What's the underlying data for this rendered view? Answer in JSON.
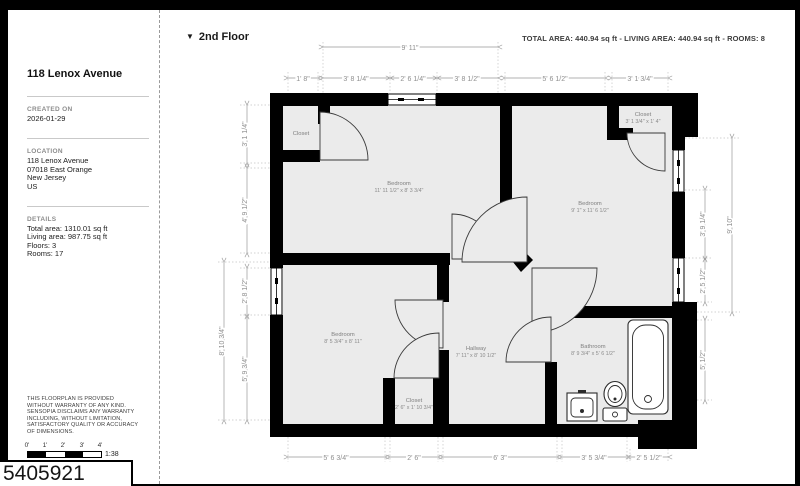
{
  "page": {
    "id_label": "5405921"
  },
  "header": {
    "floor_selector": "2nd Floor",
    "dropdown_icon": "▼",
    "summary": "TOTAL AREA: 440.94 sq ft - LIVING AREA: 440.94 sq ft - ROOMS: 8"
  },
  "sidebar": {
    "title": "118 Lenox Avenue",
    "created": {
      "heading": "CREATED ON",
      "value": "2026-01-29"
    },
    "location": {
      "heading": "LOCATION",
      "lines": [
        "118 Lenox Avenue",
        "07018 East Orange",
        "New Jersey",
        "US"
      ]
    },
    "details": {
      "heading": "DETAILS",
      "lines": [
        "Total area: 1310.01 sq ft",
        "Living area: 987.75 sq ft",
        "Floors: 3",
        "Rooms: 17"
      ]
    },
    "disclaimer": "THIS FLOORPLAN IS PROVIDED WITHOUT WARRANTY OF ANY KIND. SENSOPIA DISCLAIMS ANY WARRANTY INCLUDING, WITHOUT LIMITATION, SATISFACTORY QUALITY OR ACCURACY OF DIMENSIONS.",
    "scale": {
      "ticks": [
        "0'",
        "1'",
        "2'",
        "3'",
        "4'"
      ],
      "ratio": "1:38"
    }
  },
  "plan": {
    "rooms": [
      {
        "name": "Closet",
        "size": ""
      },
      {
        "name": "Bedroom",
        "size": "11' 11 1/2\" x 8' 3 3/4\""
      },
      {
        "name": "Closet",
        "size": "3' 1 3/4\" x 1' 4\""
      },
      {
        "name": "Bedroom",
        "size": "9' 1\" x 11' 6 1/2\""
      },
      {
        "name": "Bedroom",
        "size": "8' 5 3/4\" x 8' 11\""
      },
      {
        "name": "Closet",
        "size": "2' 6\" x 1' 10 3/4\""
      },
      {
        "name": "Hallway",
        "size": "7' 11\" x 8' 10 1/2\""
      },
      {
        "name": "Bathroom",
        "size": "8' 9 3/4\" x 5' 6 1/2\""
      }
    ],
    "dims": {
      "top_outer": "9' 11\"",
      "top": [
        "1' 8\"",
        "3' 8 1/4\"",
        "2' 6 1/4\"",
        "3' 8 1/2\"",
        "5' 6 1/2\"",
        "3' 1 3/4\""
      ],
      "bottom": [
        "5' 6 3/4\"",
        "2' 6\"",
        "6' 3\"",
        "3' 5 3/4\"",
        "2' 5 1/2\""
      ],
      "left": [
        "3' 1 1/4\"",
        "4' 9 1/2\"",
        "2' 8 1/2\"",
        "5' 9 3/4\""
      ],
      "left_outer": "8' 10 3/4\"",
      "right": [
        "3' 9 1/4\"",
        "2' 5 1/2\"",
        "5' 1/2\""
      ],
      "right_outer": "9' 10\""
    }
  },
  "colors": {
    "wall": "#000000",
    "room_fill": "#ebebeb",
    "dim": "#8f8f8f",
    "frame": "#000000"
  }
}
